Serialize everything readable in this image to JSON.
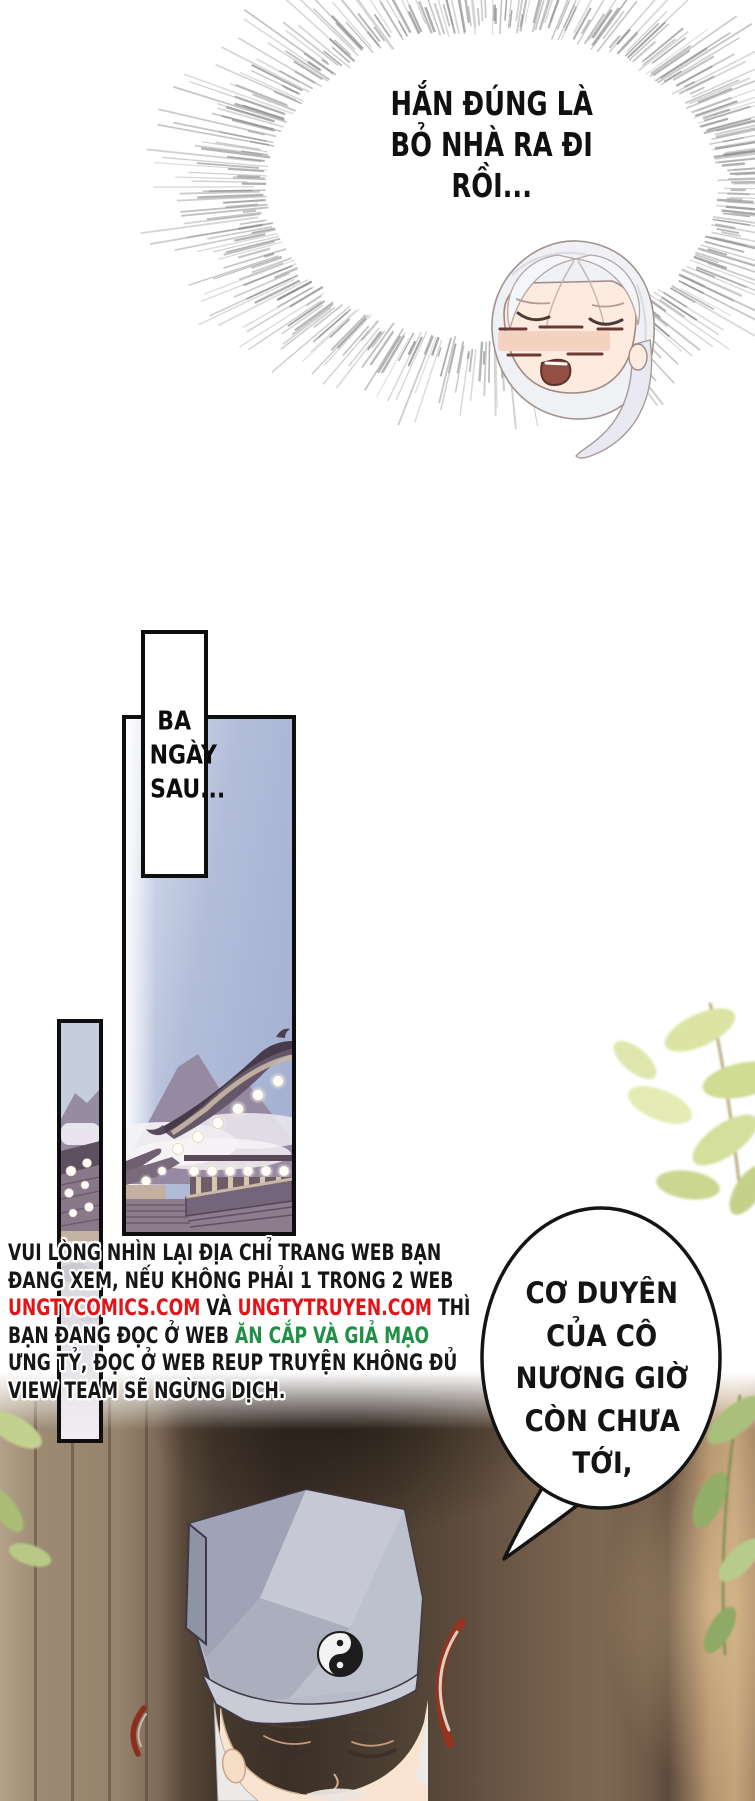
{
  "page_title": "manhua comic page (Vietnamese translation)",
  "burst_bubble": {
    "lines": [
      "HẮN ĐÚNG LÀ",
      "BỎ NHÀ RA ĐI",
      "RỒI..."
    ]
  },
  "caption_box": {
    "lines": [
      "BA",
      "NGÀY",
      "SAU..."
    ]
  },
  "piracy_notice": {
    "segments_by_line": [
      [
        {
          "t": "VUI LÒNG NHÌN LẠI ĐỊA CHỈ TRANG WEB BẠN",
          "c": "black"
        }
      ],
      [
        {
          "t": "ĐANG XEM, NẾU KHÔNG PHẢI 1 TRONG 2 WEB",
          "c": "black"
        }
      ],
      [
        {
          "t": "UNGTYCOMICS.COM",
          "c": "red"
        },
        {
          "t": " VÀ ",
          "c": "black"
        },
        {
          "t": "UNGTYTRUYEN.COM",
          "c": "red"
        },
        {
          "t": " THÌ",
          "c": "black"
        }
      ],
      [
        {
          "t": "BẠN ĐANG ĐỌC Ở WEB ",
          "c": "black"
        },
        {
          "t": "ĂN CẮP VÀ GIẢ MẠO",
          "c": "green"
        }
      ],
      [
        {
          "t": "ƯNG TỶ, ĐỌC Ở WEB REUP TRUYỆN KHÔNG ĐỦ",
          "c": "black"
        }
      ],
      [
        {
          "t": "VIEW TEAM SẼ NGỪNG DỊCH.",
          "c": "black"
        }
      ]
    ],
    "colors": {
      "black": "#161616",
      "red": "#e41317",
      "green": "#1f9045"
    }
  },
  "speech_bubble": {
    "lines": [
      "CƠ DUYÊN",
      "CỦA CÔ",
      "NƯƠNG GIỜ",
      "CÒN CHƯA",
      "TỚI,"
    ]
  },
  "art_colors": {
    "panel_border": "#0e0e0e",
    "sky": "#b2bdd9",
    "burst_gray": "#9b9b9b",
    "hat_gray_blue": "#b7bac8",
    "skin": "#f8e4d1",
    "wood_brown": "#46392e",
    "leaf_green": "#cfdc92",
    "swoosh_red": "#96321d"
  },
  "icons": {
    "yin_yang": "yin-yang"
  }
}
